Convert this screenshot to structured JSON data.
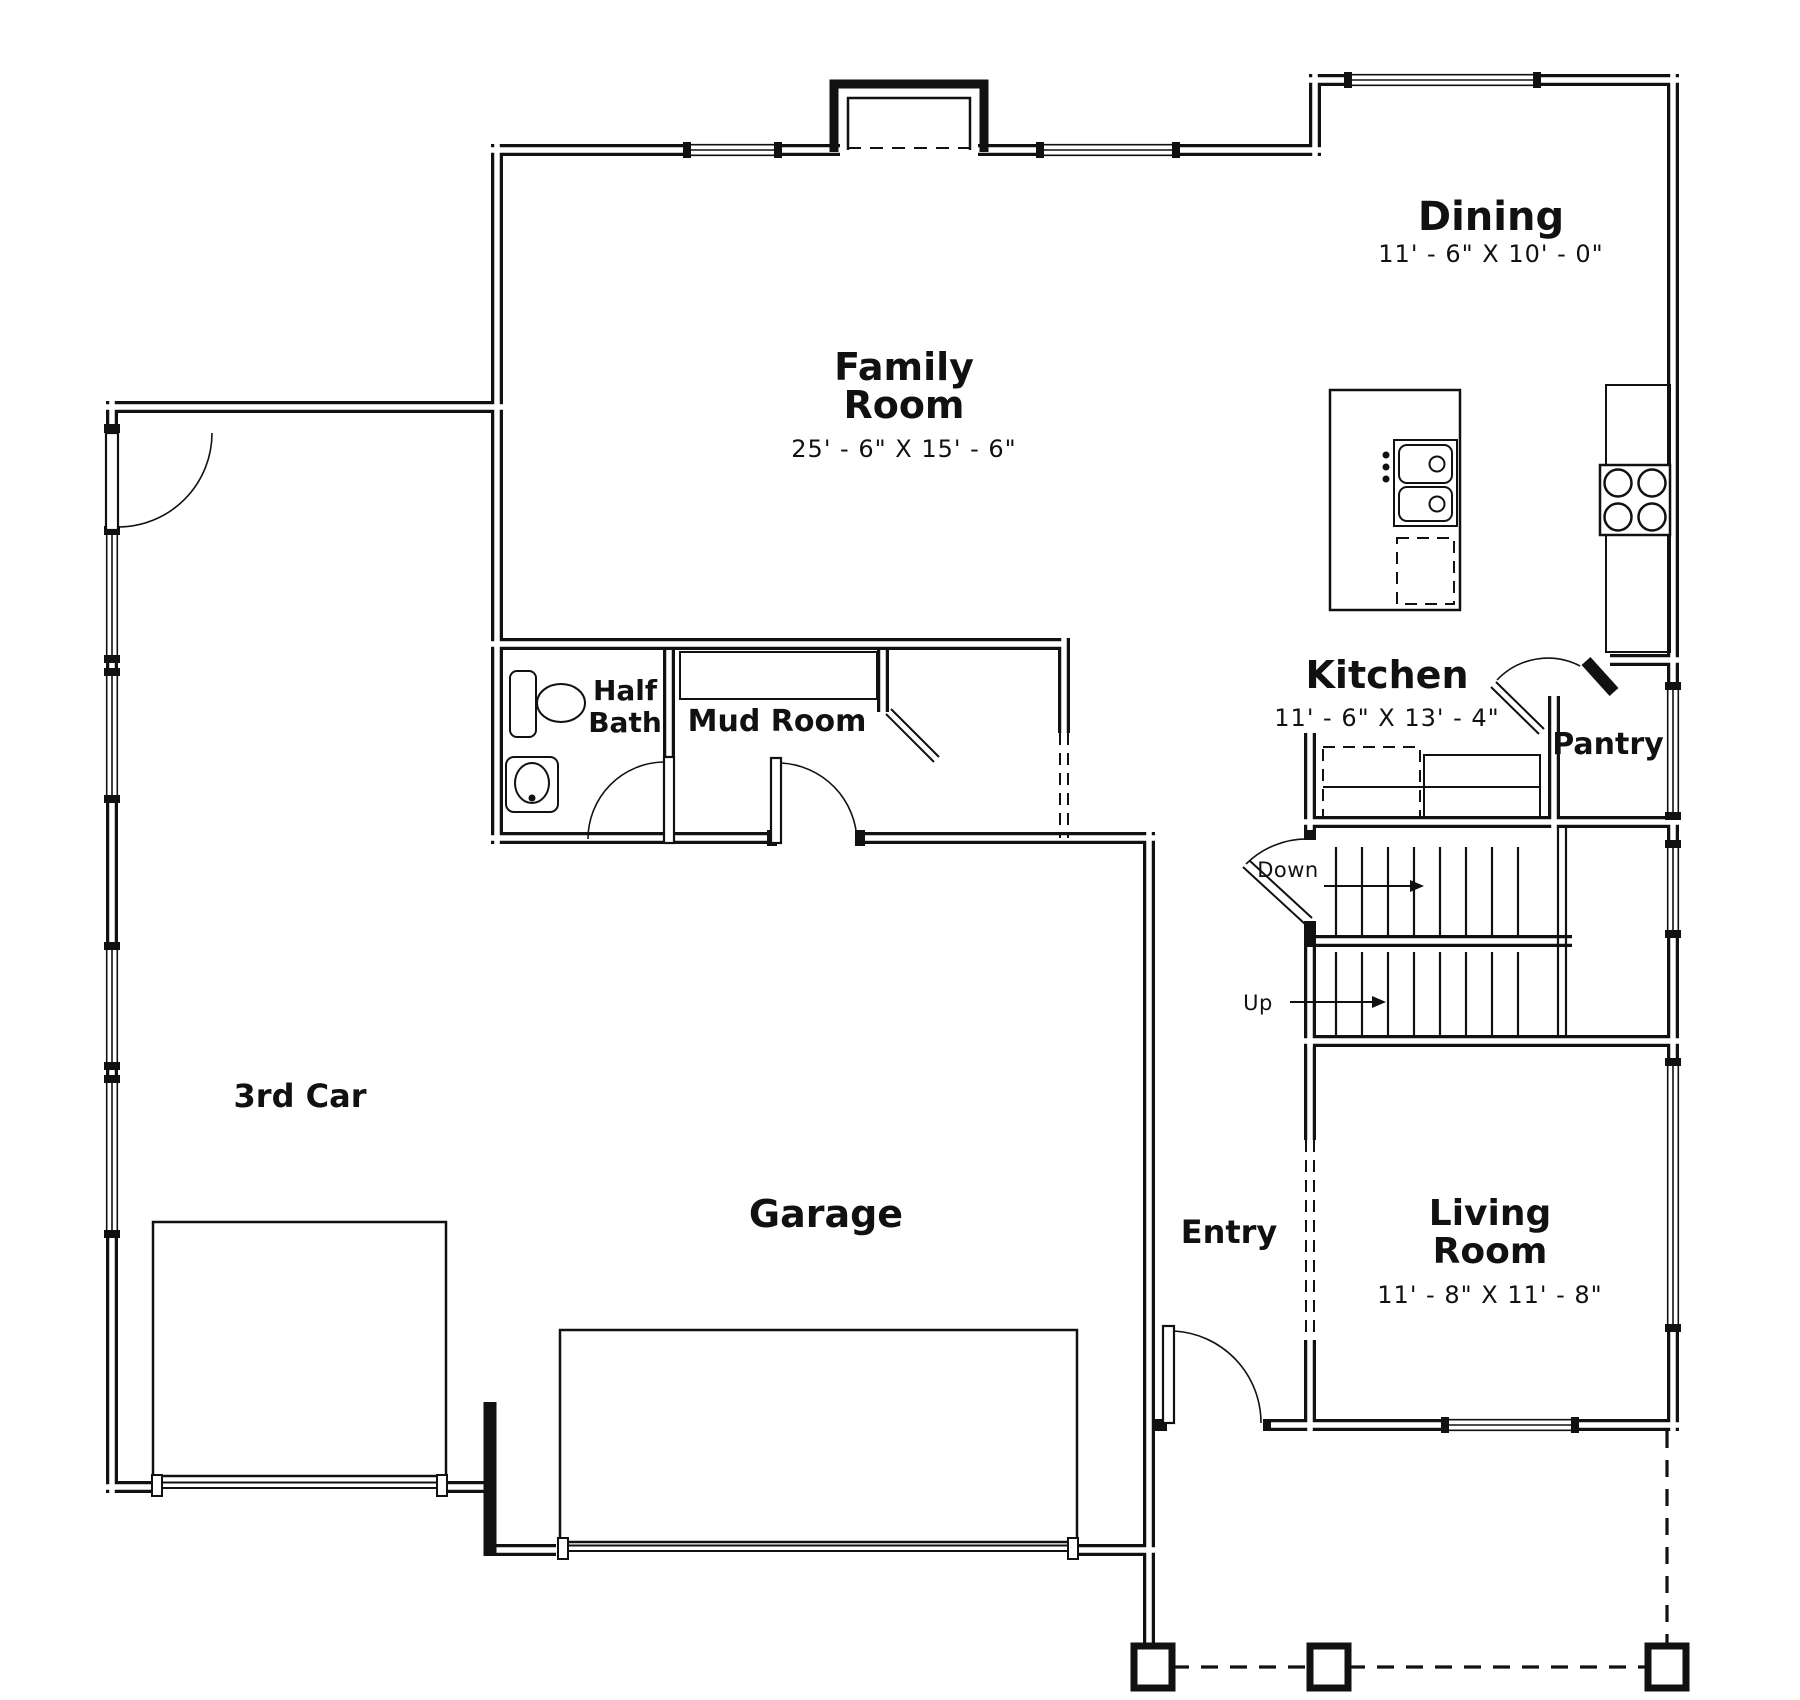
{
  "plan": {
    "rooms": {
      "family_room": {
        "line1": "Family",
        "line2": "Room",
        "dims": "25' - 6\" X 15' - 6\""
      },
      "dining": {
        "name": "Dining",
        "dims": "11' - 6\" X 10' - 0\""
      },
      "kitchen": {
        "name": "Kitchen",
        "dims": "11' - 6\" X 13' - 4\""
      },
      "pantry": {
        "name": "Pantry"
      },
      "half_bath": {
        "line1": "Half",
        "line2": "Bath"
      },
      "mud_room": {
        "name": "Mud Room"
      },
      "third_car": {
        "name": "3rd Car"
      },
      "garage": {
        "name": "Garage"
      },
      "entry": {
        "name": "Entry"
      },
      "living_room": {
        "line1": "Living",
        "line2": "Room",
        "dims": "11' - 8\" X 11' - 8\""
      }
    },
    "stairs": {
      "down": "Down",
      "up": "Up"
    },
    "colors": {
      "line": "#111111",
      "background": "#ffffff"
    }
  }
}
